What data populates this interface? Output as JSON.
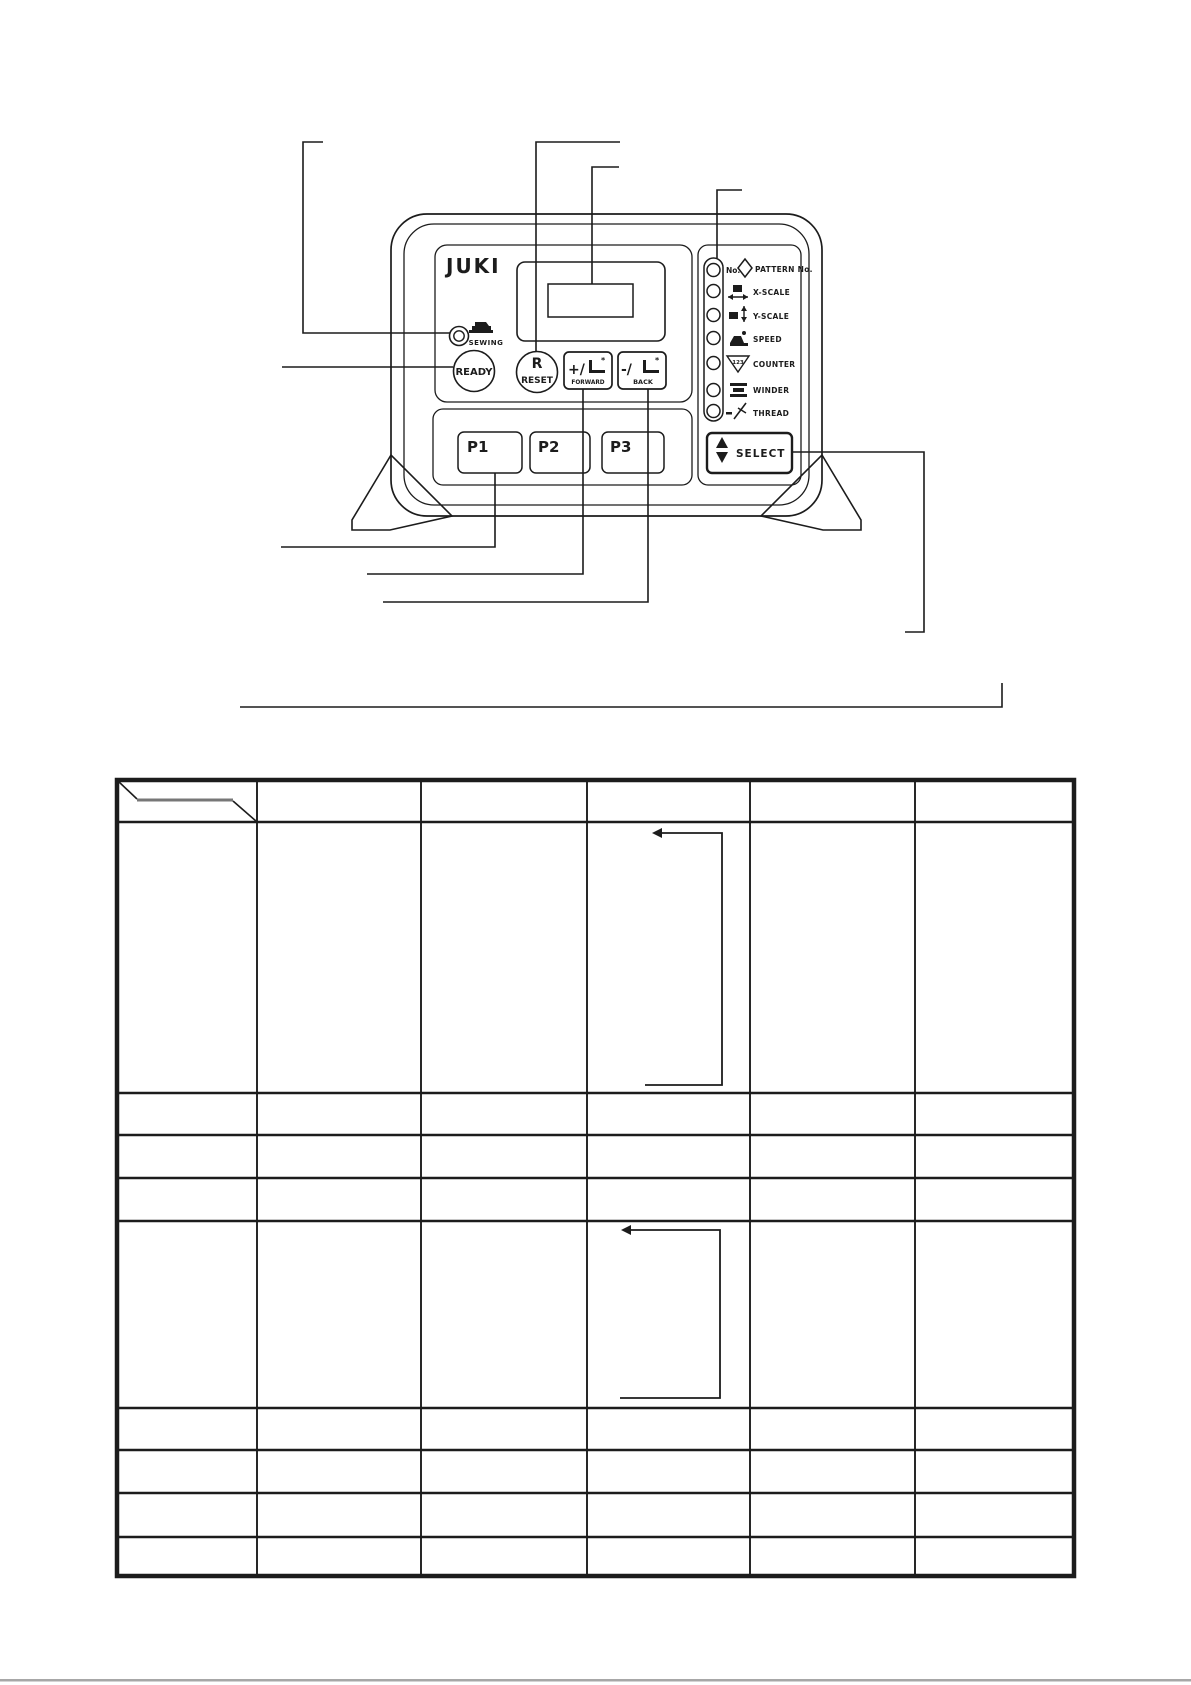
{
  "page": {
    "background": "#ffffff",
    "ink_color": "#1c1c1c",
    "artifact_color": "#8a8a8a"
  },
  "panel": {
    "brand": "JUKI",
    "sewing_indicator": {
      "label": "SEWING"
    },
    "ready_button": {
      "label": "READY"
    },
    "reset_button": {
      "letter": "R",
      "label": "RESET"
    },
    "forward_button": {
      "symbol": "+/",
      "label": "FORWARD"
    },
    "back_button": {
      "symbol": "-/",
      "label": "BACK"
    },
    "p_buttons": [
      "P1",
      "P2",
      "P3"
    ],
    "select_button": {
      "label": "SELECT",
      "icon": "up-down-arrows-icon"
    },
    "led_legend": [
      {
        "icon": "pattern-number-icon",
        "prefix": "No.",
        "label": "PATTERN No."
      },
      {
        "icon": "x-scale-icon",
        "label": "X-SCALE"
      },
      {
        "icon": "y-scale-icon",
        "label": "Y-SCALE"
      },
      {
        "icon": "speed-icon",
        "label": "SPEED"
      },
      {
        "icon": "counter-icon",
        "digits": "123",
        "label": "COUNTER"
      },
      {
        "icon": "winder-icon",
        "label": "WINDER"
      },
      {
        "icon": "thread-icon",
        "label": "THREAD"
      }
    ]
  },
  "table": {
    "columns": 6,
    "body_rows": 9,
    "header_has_diagonal_divider": true,
    "cells_text": "",
    "arrow_annotations": 2
  }
}
